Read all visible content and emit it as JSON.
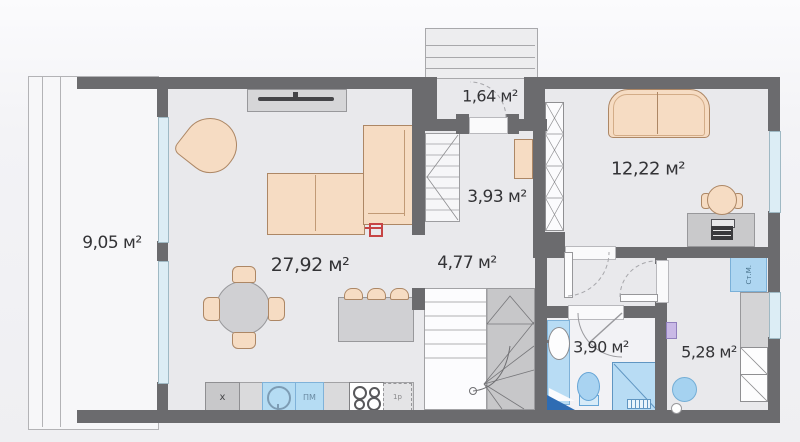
{
  "plan_title": "floor-plan",
  "rooms": {
    "terrace": {
      "label": "9,05 м²"
    },
    "living": {
      "label": "27,92 м²"
    },
    "vestibule": {
      "label": "1,64 м²"
    },
    "hall": {
      "label": "3,93 м²"
    },
    "hallway": {
      "label": "4,77 м²"
    },
    "bedroom": {
      "label": "12,22 м²"
    },
    "bathroom": {
      "label": "3,90 м²"
    },
    "utility": {
      "label": "5,28 м²"
    }
  },
  "kitchen": {
    "cabinet_label": "x",
    "dishwasher_label": "ПМ",
    "end_unit_label": "1р"
  },
  "utility_labels": {
    "washing_machine": "Ст.М."
  },
  "colors": {
    "wall": "#6b6b6e",
    "room_fill": "#e9e9ec",
    "furniture_peach": "#f6dcc3",
    "fixture_blue": "#aed6f1",
    "window_glass": "#dcedf5",
    "shower_dark_blue": "#2e6cb3",
    "socket_red": "#c64444",
    "marker_lilac": "#c9b9e6"
  }
}
